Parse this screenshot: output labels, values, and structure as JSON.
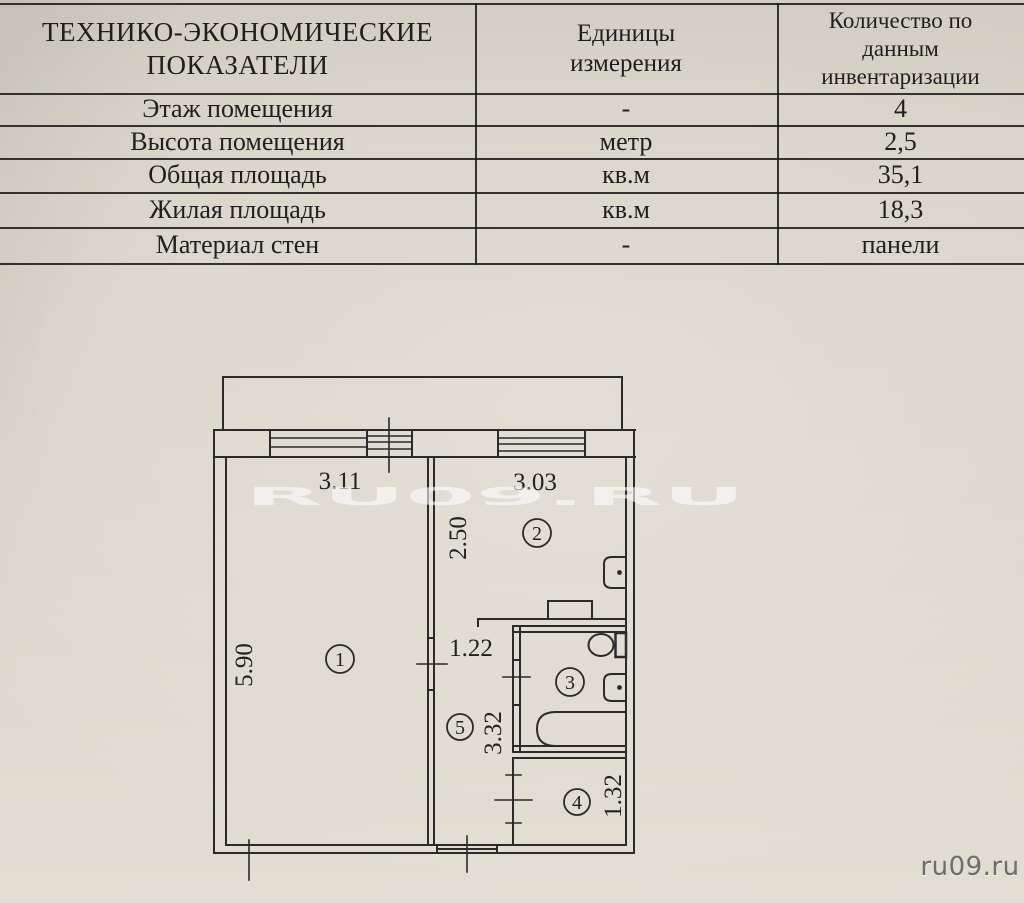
{
  "table": {
    "header": {
      "col1_line1": "ТЕХНИКО-ЭКОНОМИЧЕСКИЕ",
      "col1_line2": "ПОКАЗАТЕЛИ",
      "col2_line1": "Единицы",
      "col2_line2": "измерения",
      "col3_line1": "Количество по",
      "col3_line2": "данным",
      "col3_line3": "инвентаризации"
    },
    "rows": [
      {
        "label": "Этаж помещения",
        "unit": "-",
        "value": "4"
      },
      {
        "label": "Высота помещения",
        "unit": "метр",
        "value": "2,5"
      },
      {
        "label": "Общая площадь",
        "unit": "кв.м",
        "value": "35,1"
      },
      {
        "label": "Жилая площадь",
        "unit": "кв.м",
        "value": "18,3"
      },
      {
        "label": "Материал стен",
        "unit": "-",
        "value": "панели"
      }
    ]
  },
  "plan": {
    "dimensions": {
      "room1_width": "3.11",
      "kitchen_width": "3.03",
      "kitchen_depth": "2.50",
      "room1_length": "5.90",
      "hall_width": "1.22",
      "hall_length": "3.32",
      "room4_depth": "1.32"
    },
    "room_numbers": [
      "1",
      "2",
      "3",
      "4",
      "5"
    ]
  },
  "watermark": {
    "text": "RU09.RU"
  },
  "brand": {
    "text": "ru09.ru"
  }
}
